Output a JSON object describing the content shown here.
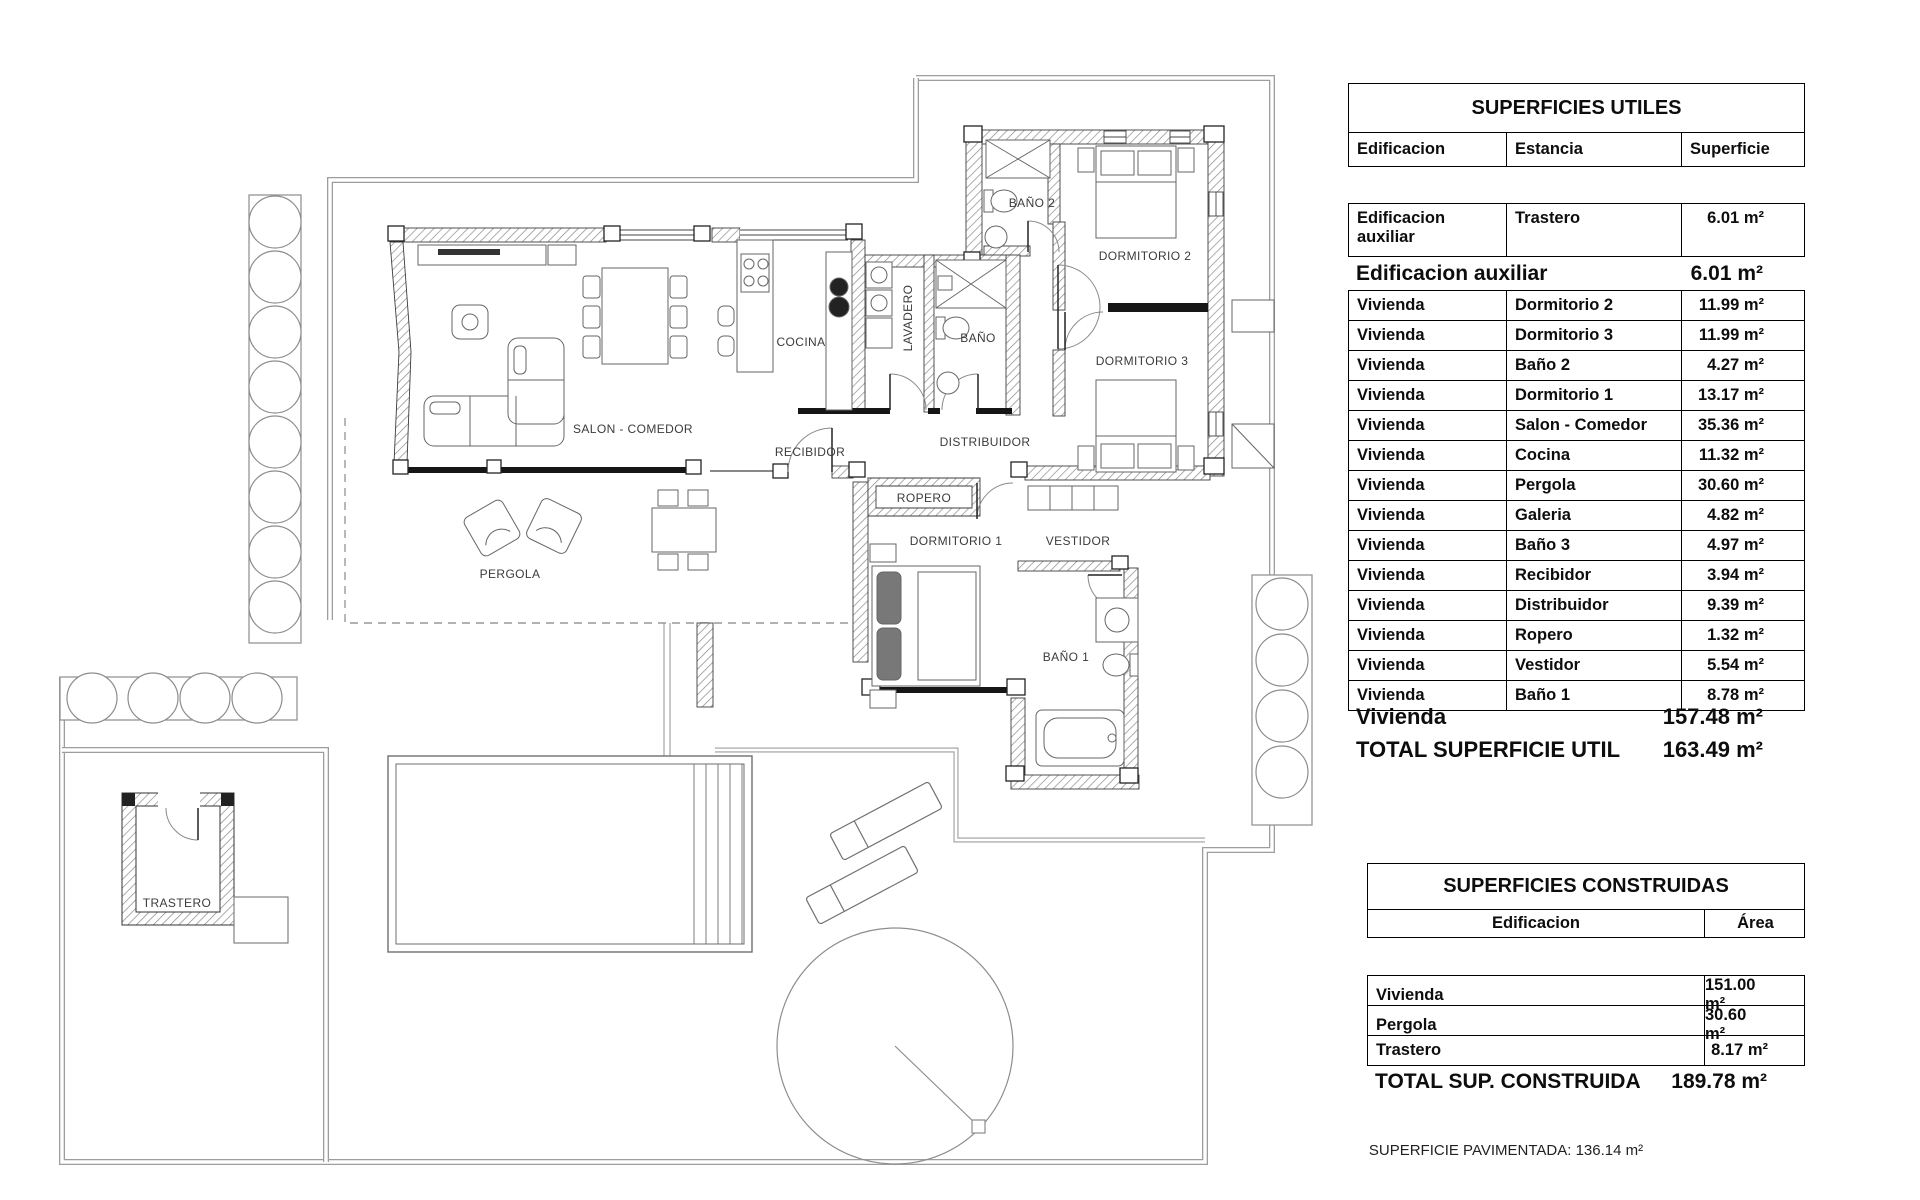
{
  "plan": {
    "labels": [
      {
        "id": "salon",
        "text": "SALON - COMEDOR"
      },
      {
        "id": "cocina",
        "text": "COCINA"
      },
      {
        "id": "lavadero",
        "text": "LAVADERO"
      },
      {
        "id": "bano",
        "text": "BAÑO"
      },
      {
        "id": "bano2",
        "text": "BAÑO 2"
      },
      {
        "id": "dormitorio2",
        "text": "DORMITORIO 2"
      },
      {
        "id": "dormitorio3",
        "text": "DORMITORIO 3"
      },
      {
        "id": "recibidor",
        "text": "RECIBIDOR"
      },
      {
        "id": "distribuidor",
        "text": "DISTRIBUIDOR"
      },
      {
        "id": "ropero",
        "text": "ROPERO"
      },
      {
        "id": "dormitorio1",
        "text": "DORMITORIO 1"
      },
      {
        "id": "vestidor",
        "text": "VESTIDOR"
      },
      {
        "id": "bano1",
        "text": "BAÑO 1"
      },
      {
        "id": "pergola",
        "text": "PERGOLA"
      },
      {
        "id": "trastero",
        "text": "TRASTERO"
      }
    ]
  },
  "tables": {
    "utiles": {
      "title": "SUPERFICIES UTILES",
      "col_edificacion": "Edificacion",
      "col_estancia": "Estancia",
      "col_superficie": "Superficie",
      "aux_row": {
        "edificacion": "Edificacion auxiliar",
        "estancia": "Trastero",
        "superficie": "6.01 m²"
      },
      "aux_subtotal": {
        "label": "Edificacion auxiliar",
        "value": "6.01 m²"
      },
      "rows": [
        {
          "edificacion": "Vivienda",
          "estancia": "Dormitorio 2",
          "superficie": "11.99 m²"
        },
        {
          "edificacion": "Vivienda",
          "estancia": "Dormitorio 3",
          "superficie": "11.99 m²"
        },
        {
          "edificacion": "Vivienda",
          "estancia": "Baño 2",
          "superficie": "4.27 m²"
        },
        {
          "edificacion": "Vivienda",
          "estancia": "Dormitorio 1",
          "superficie": "13.17 m²"
        },
        {
          "edificacion": "Vivienda",
          "estancia": "Salon - Comedor",
          "superficie": "35.36 m²"
        },
        {
          "edificacion": "Vivienda",
          "estancia": "Cocina",
          "superficie": "11.32 m²"
        },
        {
          "edificacion": "Vivienda",
          "estancia": "Pergola",
          "superficie": "30.60 m²"
        },
        {
          "edificacion": "Vivienda",
          "estancia": "Galeria",
          "superficie": "4.82 m²"
        },
        {
          "edificacion": "Vivienda",
          "estancia": "Baño 3",
          "superficie": "4.97 m²"
        },
        {
          "edificacion": "Vivienda",
          "estancia": "Recibidor",
          "superficie": "3.94 m²"
        },
        {
          "edificacion": "Vivienda",
          "estancia": "Distribuidor",
          "superficie": "9.39 m²"
        },
        {
          "edificacion": "Vivienda",
          "estancia": "Ropero",
          "superficie": "1.32 m²"
        },
        {
          "edificacion": "Vivienda",
          "estancia": "Vestidor",
          "superficie": "5.54 m²"
        },
        {
          "edificacion": "Vivienda",
          "estancia": "Baño 1",
          "superficie": "8.78 m²"
        }
      ],
      "vivienda_subtotal": {
        "label": "Vivienda",
        "value": "157.48 m²"
      },
      "total": {
        "label": "TOTAL SUPERFICIE UTIL",
        "value": "163.49 m²"
      }
    },
    "construidas": {
      "title": "SUPERFICIES CONSTRUIDAS",
      "col_edificacion": "Edificacion",
      "col_area": "Área",
      "rows": [
        {
          "edificacion": "Vivienda",
          "area": "151.00 m²"
        },
        {
          "edificacion": "Pergola",
          "area": "30.60 m²"
        },
        {
          "edificacion": "Trastero",
          "area": "8.17 m²"
        }
      ],
      "total": {
        "label": "TOTAL SUP. CONSTRUIDA",
        "value": "189.78 m²"
      }
    },
    "footer_note": "SUPERFICIE PAVIMENTADA: 136.14 m²"
  }
}
